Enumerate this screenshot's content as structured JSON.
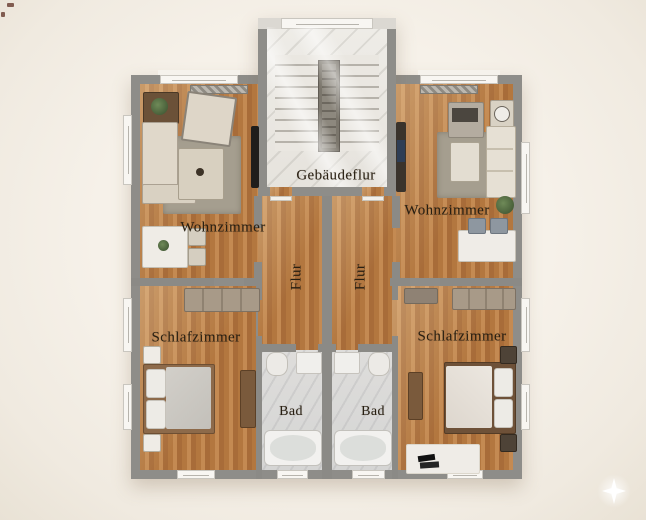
{
  "scene": {
    "type": "apartment-floor-plan-rendering",
    "description": "Top-down rendered floor plan of two mirrored apartments around a central stairwell"
  },
  "palette": {
    "background": "#f3eee6",
    "wall": "#8e8d89",
    "wood_floor": "#b97f48",
    "stairwell_marble": "#ebe9e4",
    "bathroom_floor": "#dcdbd9",
    "label_text": "#281f12",
    "sparkle": "#ffffff"
  },
  "rooms": {
    "building_hall": {
      "label": "Gebäudeflur"
    },
    "apartment_left": {
      "living_room": {
        "label": "Wohnzimmer"
      },
      "hallway": {
        "label": "Flur"
      },
      "bedroom": {
        "label": "Schlafzimmer"
      },
      "bathroom": {
        "label": "Bad"
      }
    },
    "apartment_right": {
      "living_room": {
        "label": "Wohnzimmer"
      },
      "hallway": {
        "label": "Flur"
      },
      "bedroom": {
        "label": "Schlafzimmer"
      },
      "bathroom": {
        "label": "Bad"
      }
    }
  }
}
